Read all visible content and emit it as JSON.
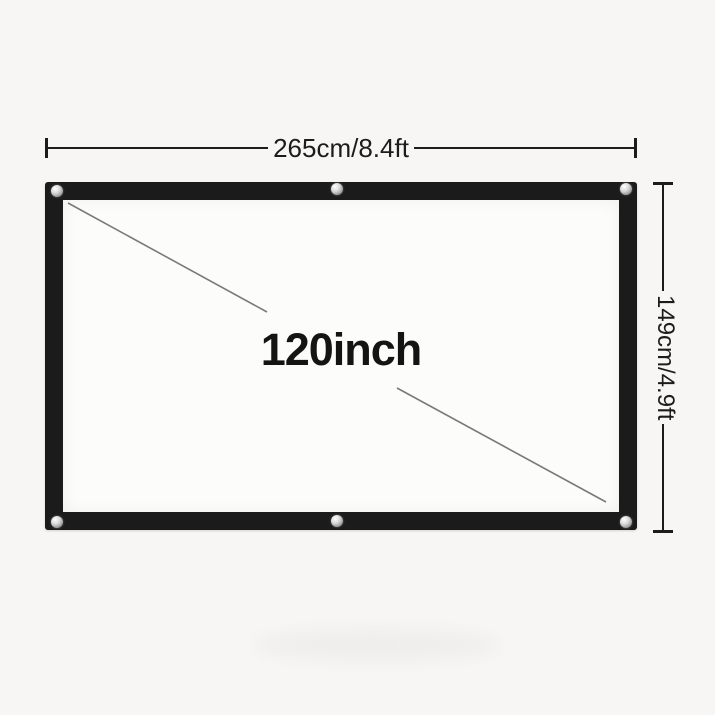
{
  "diagram": {
    "size_label": "120inch",
    "width_label": "265cm/8.4ft",
    "height_label": "149cm/4.9ft"
  },
  "colors": {
    "background": "#f7f6f4",
    "frame": "#1b1b1b",
    "screen": "#fcfcfb",
    "line": "#1c1c1c",
    "diagonal": "#7a7a7a",
    "label_text": "#1c1c1c"
  }
}
